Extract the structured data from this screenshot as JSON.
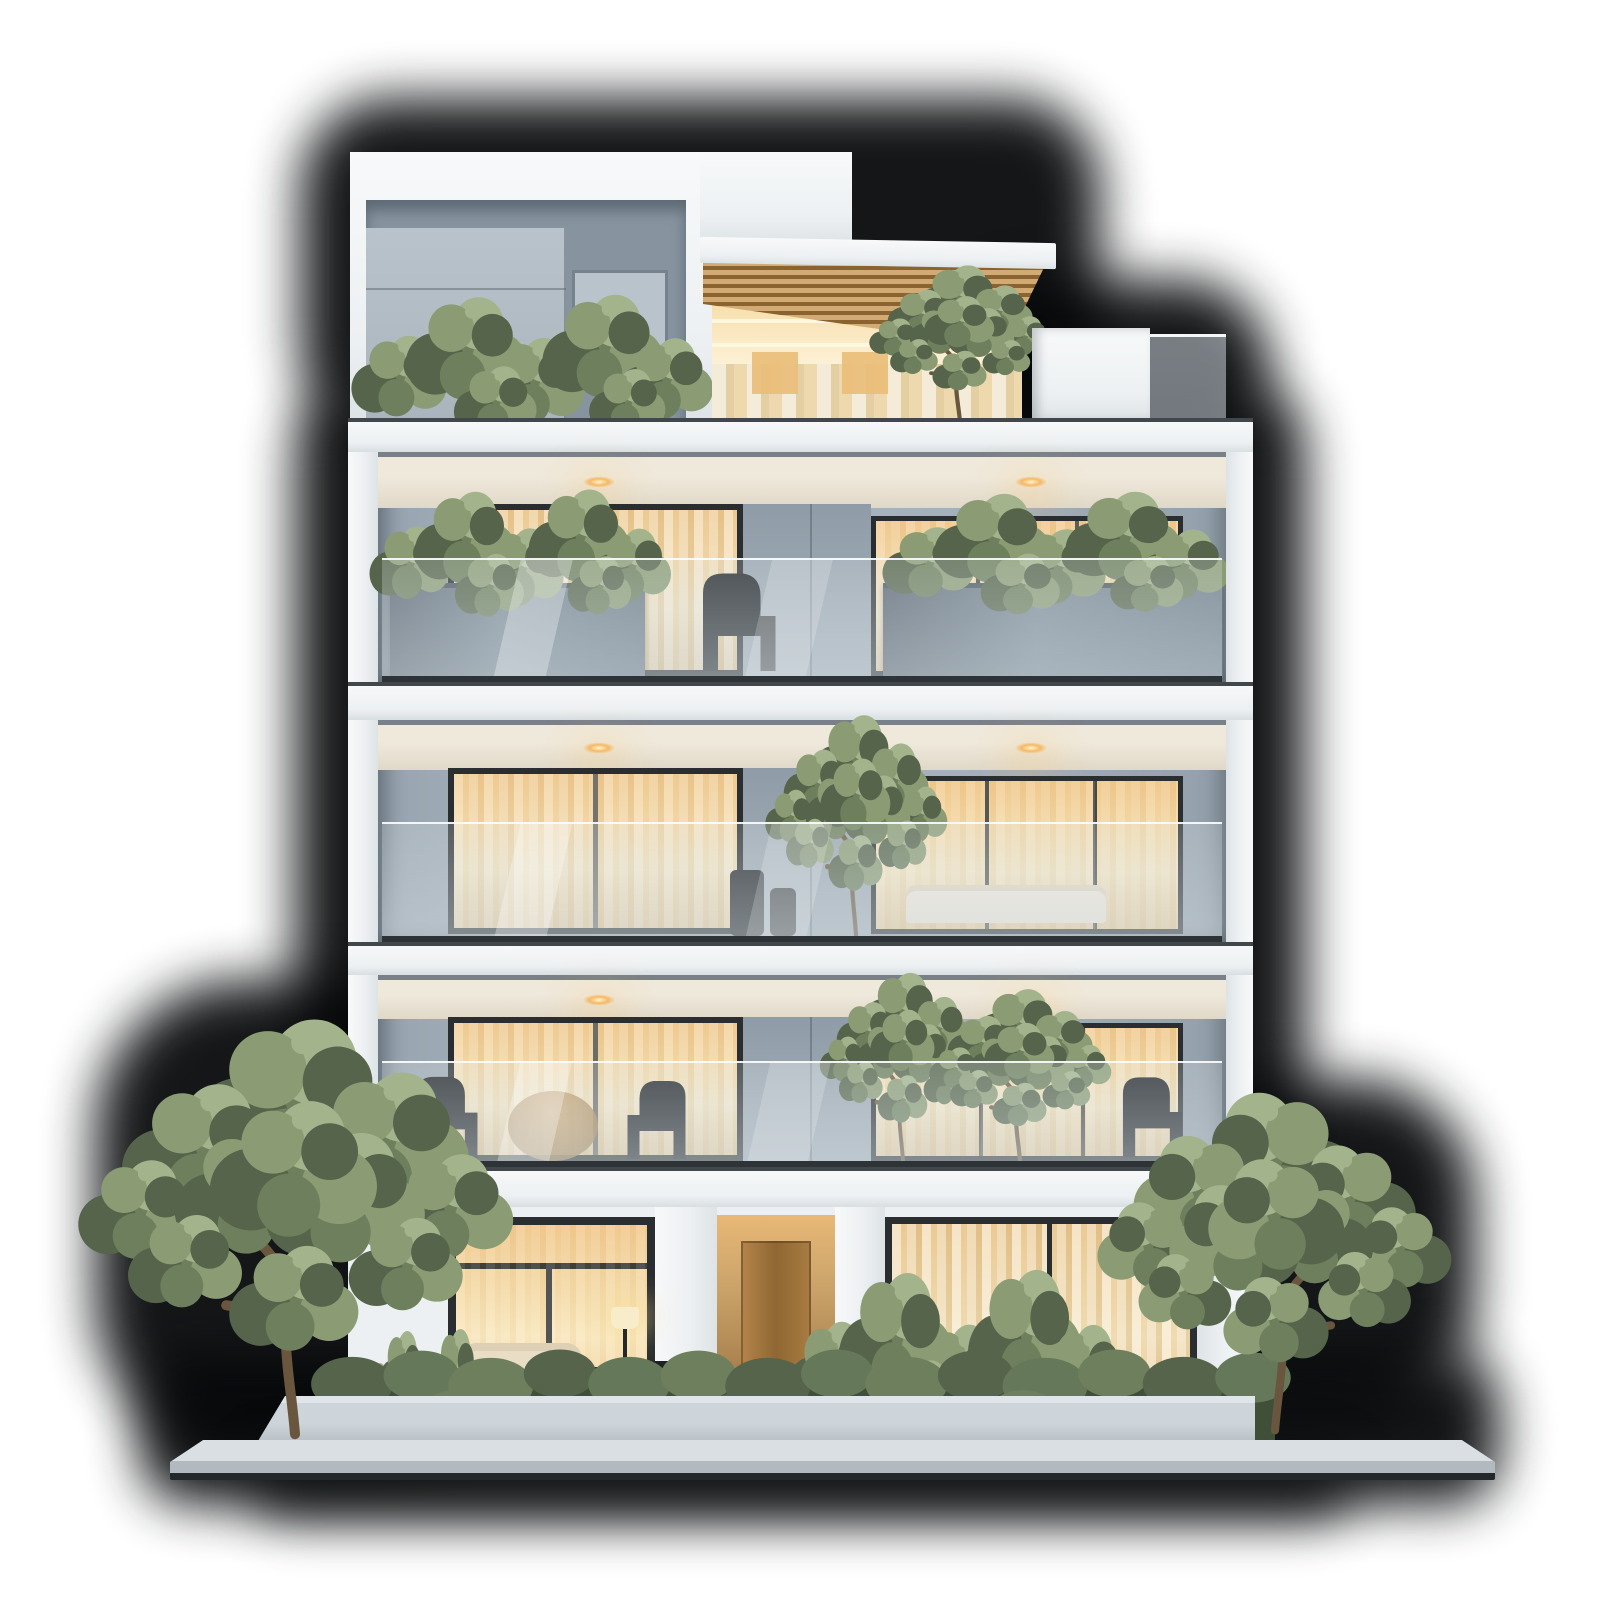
{
  "scene": {
    "alt_text": "Front elevation of a modern five-storey apartment building at dusk: white concrete slab facade, three glass-railed balcony floors with planters and warm lit interiors, rooftop penthouse with gray panel cube and wooden slat pergola, roof garden shrubs, ground floor with central wooden entrance door, living-room window with sofa and floor lamp, curtained right window, front hedge, two leafy trees and a concrete sidewalk, all over a soft black drop shadow",
    "building": {
      "storeys_visible": 5,
      "balcony_floors": 3,
      "downlights_per_balcony": 2,
      "lit_windows": "warm interior lighting on every level",
      "penthouse": {
        "left_volume": "white frame with gray metal panel cube",
        "pergola": "wood slat canopy with LED strips and curtains",
        "roof_garden": "row of green shrubs on parapet"
      },
      "ground_floor": {
        "entrance": "central recessed wooden door between white piers",
        "left_room": "living room window with sofa, patio table, chairs and lit floor lamp",
        "right_room": "full-height window with tall curtains",
        "hedge": "continuous clipped hedge with taller entrance shrubs"
      },
      "landscape": {
        "trees": 2,
        "hedge": true,
        "planter_wall": true,
        "sidewalk": true
      }
    },
    "colors": {
      "bg": "#ffffff",
      "shadow": "#06080a",
      "facadeHi": "#f7f9fa",
      "facade": "#edf0f2",
      "facadeLo": "#dde3e6",
      "slabLine": "#41474b",
      "panel": "#a9b4bd",
      "panelLo": "#8794a0",
      "panelHi": "#b9c3cb",
      "backwall": "#aeb9c2",
      "ceilWarm": "#efe9dc",
      "warmHi": "#f7dfae",
      "warmMid": "#f2c98b",
      "warmPale": "#fbeac2",
      "warmDeep": "#f3cf96",
      "frame": "#2a2e30",
      "railBase": "#2e3337",
      "wood": "#d2ab74",
      "woodDark": "#8a6330",
      "planter": "#7c8b97",
      "leafL": "#8b9c74",
      "leafM": "#6d7f5c",
      "leafD": "#55644a",
      "leafX": "#a3b48c",
      "hedgeHi": "#66785a",
      "hedgeLo": "#3f4f38",
      "trunk": "#6a563f",
      "walkTop": "#d9dfe2",
      "walkFace": "#b2bac0",
      "walkEdge": "#23282b",
      "lampGlow": "#f5b964"
    }
  }
}
